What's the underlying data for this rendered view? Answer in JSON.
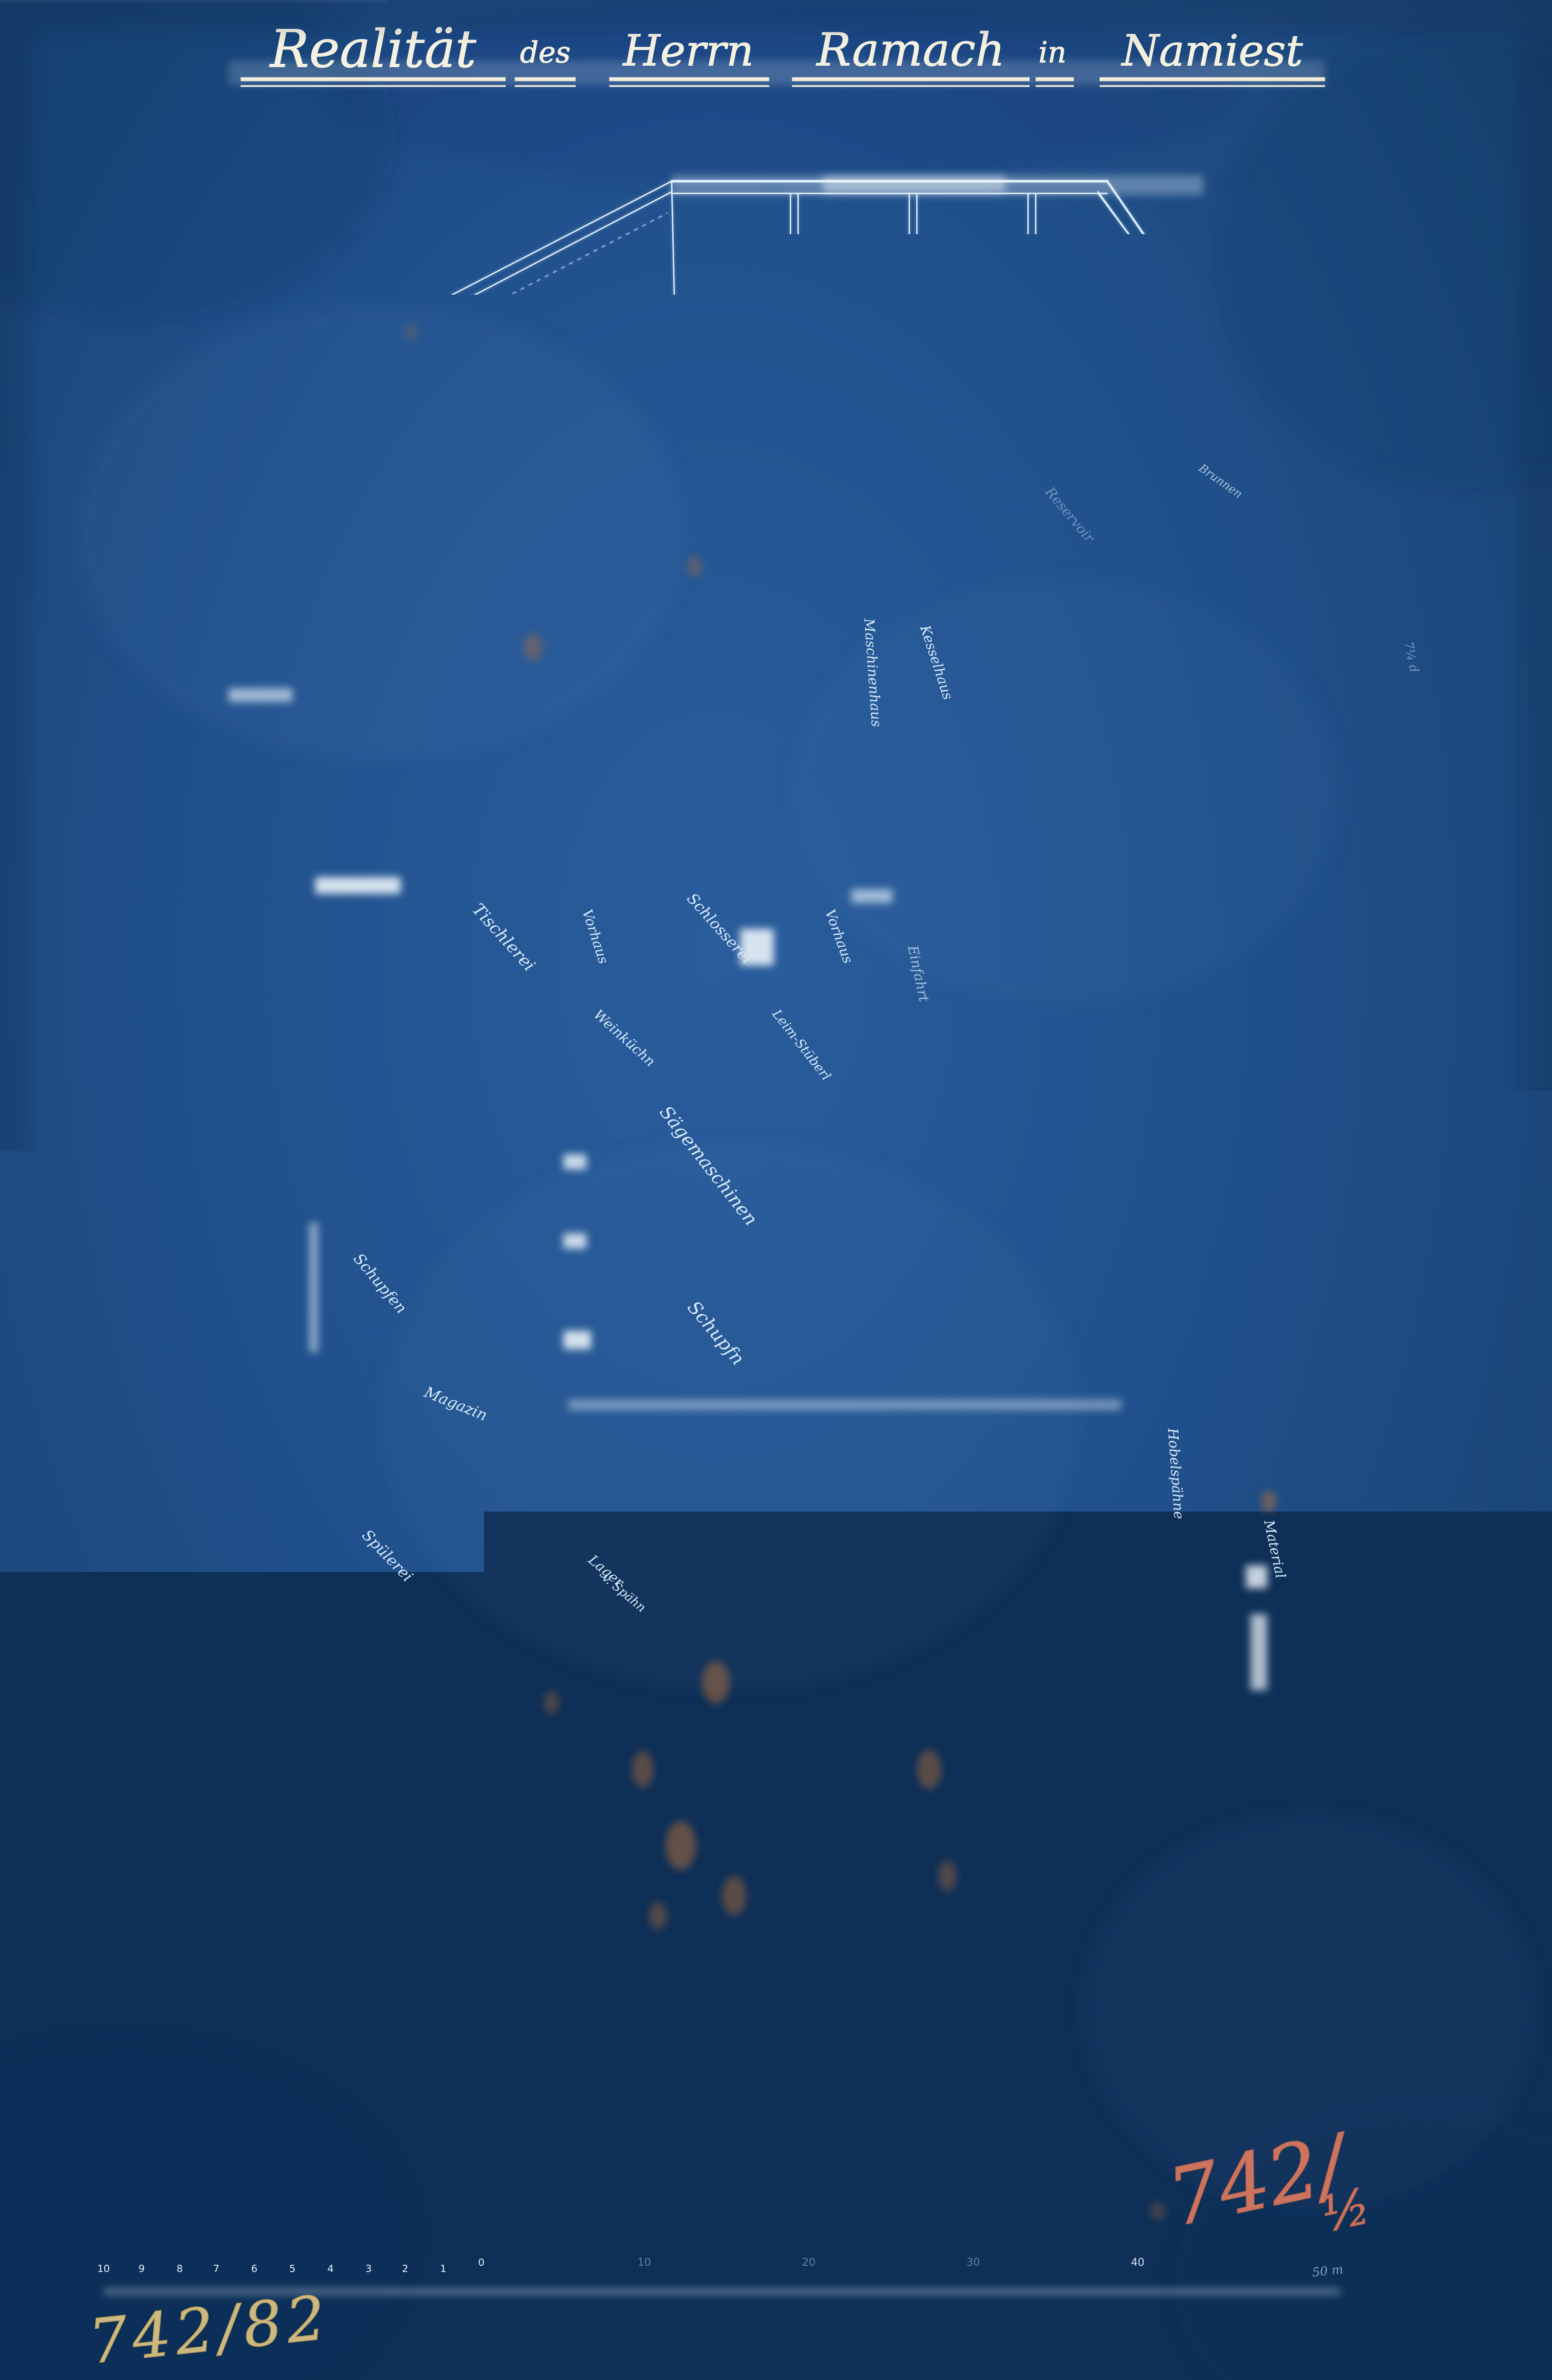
{
  "title": {
    "words": [
      "Realität",
      "des",
      "Herrn",
      "Ramach",
      "in",
      "Namiest"
    ]
  },
  "plan": {
    "rooms": {
      "tischlerei": "Tischlerei",
      "vorhaus_links": "Vorhaus",
      "schlosserei": "Schlosserei",
      "vorhaus_rechts": "Vorhaus",
      "einfahrt": "Einfahrt",
      "weinkuechn": "Weinküchn",
      "leimstueberl": "Leim-Stüberl",
      "saegemaschinen": "Sägemaschinen",
      "schupfn": "Schupfn",
      "schupfen": "Schupfen",
      "magazin": "Magazin",
      "spuelerei": "Spülerei",
      "lager_zeile1": "Lager",
      "lager_zeile2": "v. Spähn",
      "maschinenhaus": "Maschinenhaus",
      "kesselhaus": "Kesselhaus",
      "hobelspaene": "Hobelspähne",
      "material": "Material"
    },
    "annotations": {
      "well": "Brunnen",
      "reservoir": "Reservoir",
      "edge_note": "7¼ d"
    }
  },
  "notes": {
    "red_crayon": {
      "main": "742/",
      "fraction": "½"
    },
    "pencil": "742/82",
    "white_ink": {
      "line1": "zur Mauer",
      "line2": "zur Thüre"
    }
  },
  "scale_bar": {
    "minor_labels": [
      "10",
      "9",
      "8",
      "7",
      "6",
      "5",
      "4",
      "3",
      "2",
      "1",
      "0"
    ],
    "major_labels": [
      "10",
      "20",
      "30",
      "40"
    ],
    "end_label": "50 m"
  }
}
